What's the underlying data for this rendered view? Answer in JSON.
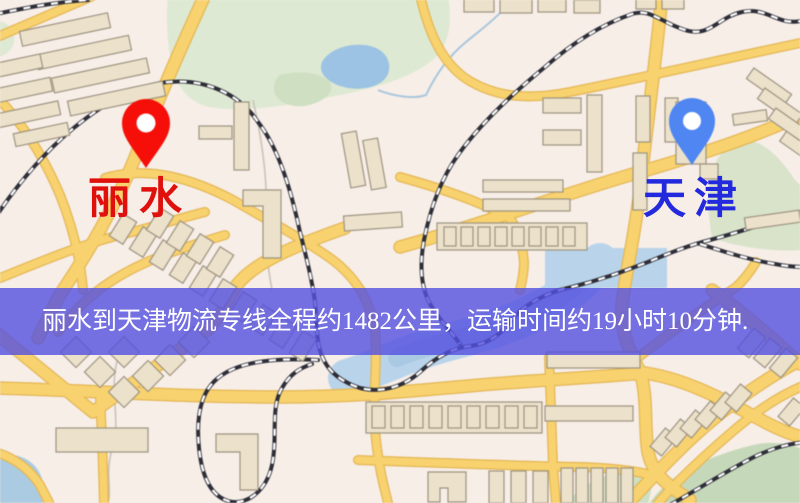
{
  "map": {
    "origin": {
      "label": "丽水",
      "pin_color": "#f50f08",
      "label_color": "#e0100c"
    },
    "destination": {
      "label": "天津",
      "pin_color": "#4f86f2",
      "label_color": "#2329dc"
    }
  },
  "banner": {
    "text": "丽水到天津物流专线全程约1482公里，运输时间约19小时10分钟.",
    "background": "rgba(84,80,224,0.80)",
    "text_color": "#ffffff"
  },
  "route_info": {
    "distance": "1482公里",
    "duration": "19小时10分钟"
  },
  "map_colors": {
    "background": "#f7eee8",
    "road": "#f8d26e",
    "building": "#ece1ca",
    "park": "#dde9d2",
    "water": "#9cc2e4",
    "railway": "#2e2e38"
  }
}
